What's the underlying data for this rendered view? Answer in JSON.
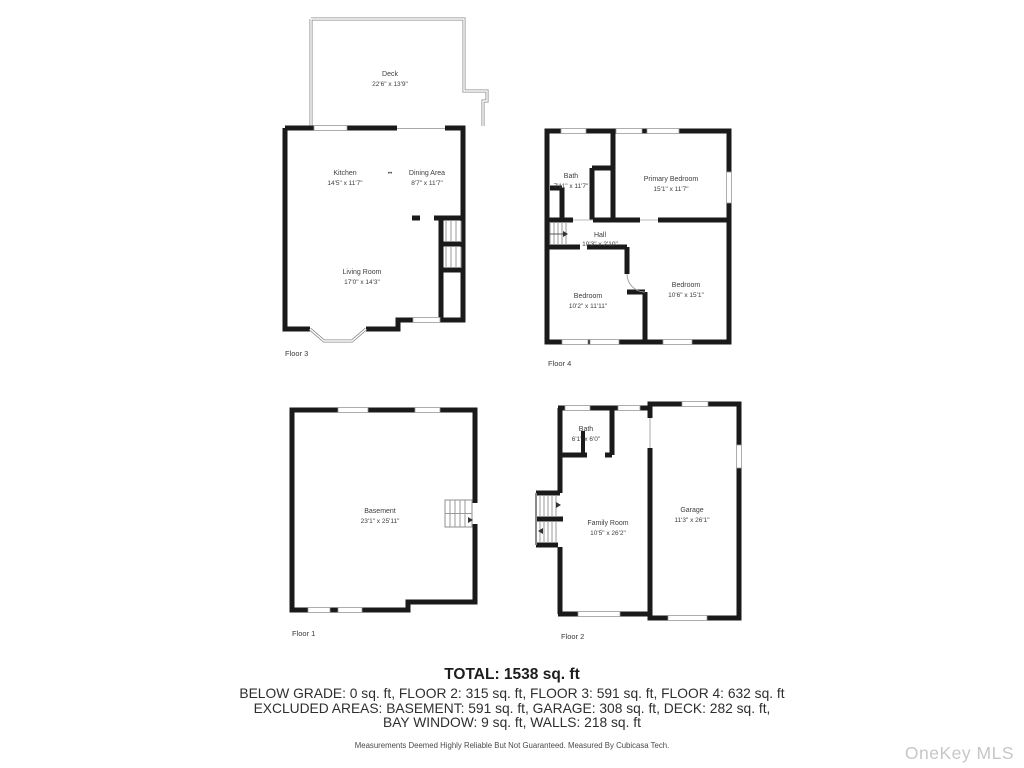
{
  "floors": {
    "floor3": {
      "caption": "Floor 3",
      "decor_dots": "••",
      "rooms": {
        "deck": {
          "name": "Deck",
          "dims": "22'6\" x 13'9\""
        },
        "kitchen": {
          "name": "Kitchen",
          "dims": "14'5\" x 11'7\""
        },
        "dining": {
          "name": "Dining Area",
          "dims": "8'7\" x 11'7\""
        },
        "living": {
          "name": "Living Room",
          "dims": "17'0\" x 14'3\""
        }
      }
    },
    "floor4": {
      "caption": "Floor 4",
      "rooms": {
        "bath": {
          "name": "Bath",
          "dims": "7'11\" x 11'7\""
        },
        "primary_bedroom": {
          "name": "Primary Bedroom",
          "dims": "15'1\" x 11'7\""
        },
        "hall": {
          "name": "Hall",
          "dims": "10'3\" x 2'10\""
        },
        "bedroom_left": {
          "name": "Bedroom",
          "dims": "10'2\" x 11'11\""
        },
        "bedroom_right": {
          "name": "Bedroom",
          "dims": "10'6\" x 15'1\""
        }
      }
    },
    "floor1": {
      "caption": "Floor 1",
      "rooms": {
        "basement": {
          "name": "Basement",
          "dims": "23'1\" x 25'11\""
        }
      }
    },
    "floor2": {
      "caption": "Floor 2",
      "rooms": {
        "bath": {
          "name": "Bath",
          "dims": "6'1\" x 6'0\""
        },
        "family_room": {
          "name": "Family Room",
          "dims": "10'5\" x 26'2\""
        },
        "garage": {
          "name": "Garage",
          "dims": "11'3\" x 26'1\""
        }
      }
    }
  },
  "summary": {
    "total": "TOTAL: 1538 sq. ft",
    "floors_line": "BELOW GRADE: 0 sq. ft, FLOOR 2: 315 sq. ft, FLOOR 3: 591 sq. ft, FLOOR 4: 632 sq. ft",
    "excluded_line1": "EXCLUDED AREAS: BASEMENT: 591 sq. ft, GARAGE: 308 sq. ft, DECK: 282 sq. ft,",
    "excluded_line2": "BAY WINDOW: 9 sq. ft, WALLS: 218 sq. ft",
    "disclaimer": "Measurements Deemed Highly Reliable But Not Guaranteed. Measured By Cubicasa Tech."
  },
  "watermark": "OneKey MLS",
  "colors": {
    "wall": "#1a1a1a",
    "thin_wall": "#8a8a8a",
    "label_text": "#3d3d3d",
    "watermark": "#c7c7c7"
  }
}
